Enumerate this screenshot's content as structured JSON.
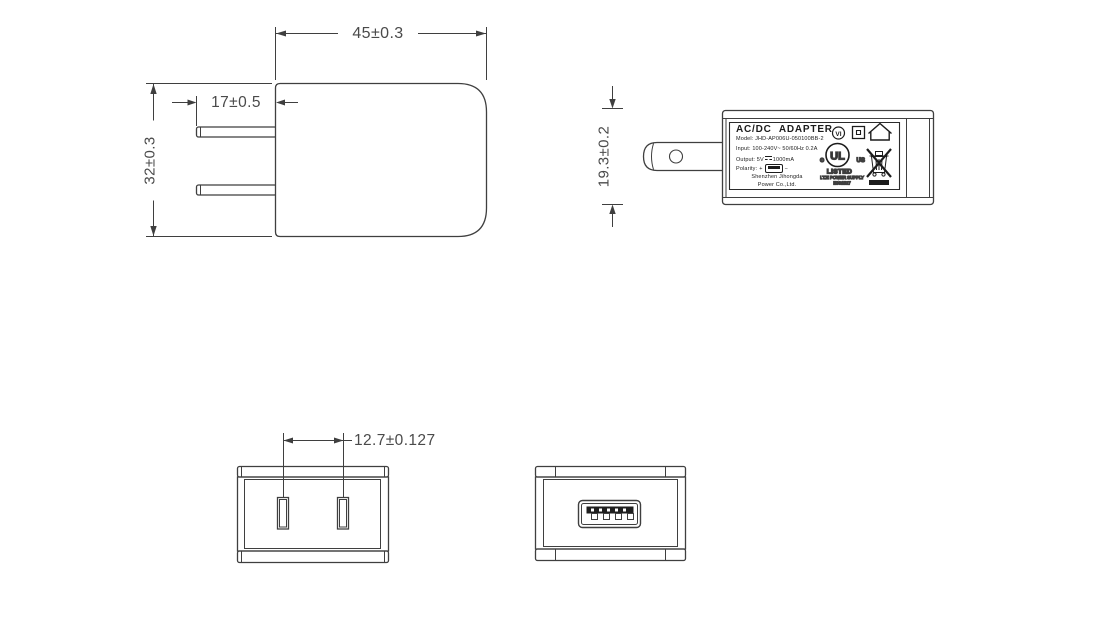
{
  "dimensions": {
    "front_width": "45±0.3",
    "prong_length": "17±0.5",
    "front_height": "32±0.3",
    "side_height": "19.3±0.2",
    "pin_pitch": "12.7±0.127"
  },
  "label": {
    "title": "AC/DC ADAPTER",
    "model": "Model: JHD-AP006U-050100BB-2",
    "input": "Input: 100-240V~ 50/60Hz 0.2A",
    "output_prefix": "Output: 5V",
    "output_value": "1000mA",
    "polarity": "Polarity:",
    "polarity_plus": "+",
    "polarity_minus": "−",
    "company_line1": "Shenzhen Jihongda",
    "company_line2": "Power Co.,Ltd."
  },
  "certifications": {
    "efficiency_mark": "VI",
    "ul_mark": "UL",
    "ul_c": "c",
    "ul_us": "US",
    "ul_listed": "LISTED",
    "ul_category": "I.T.E POWER SUPPLY",
    "ul_file": "E361527"
  },
  "colors": {
    "line": "#3f3f3f",
    "dim_text": "#4a4a4a",
    "label_ink": "#1c1c1c",
    "background": "#ffffff"
  }
}
